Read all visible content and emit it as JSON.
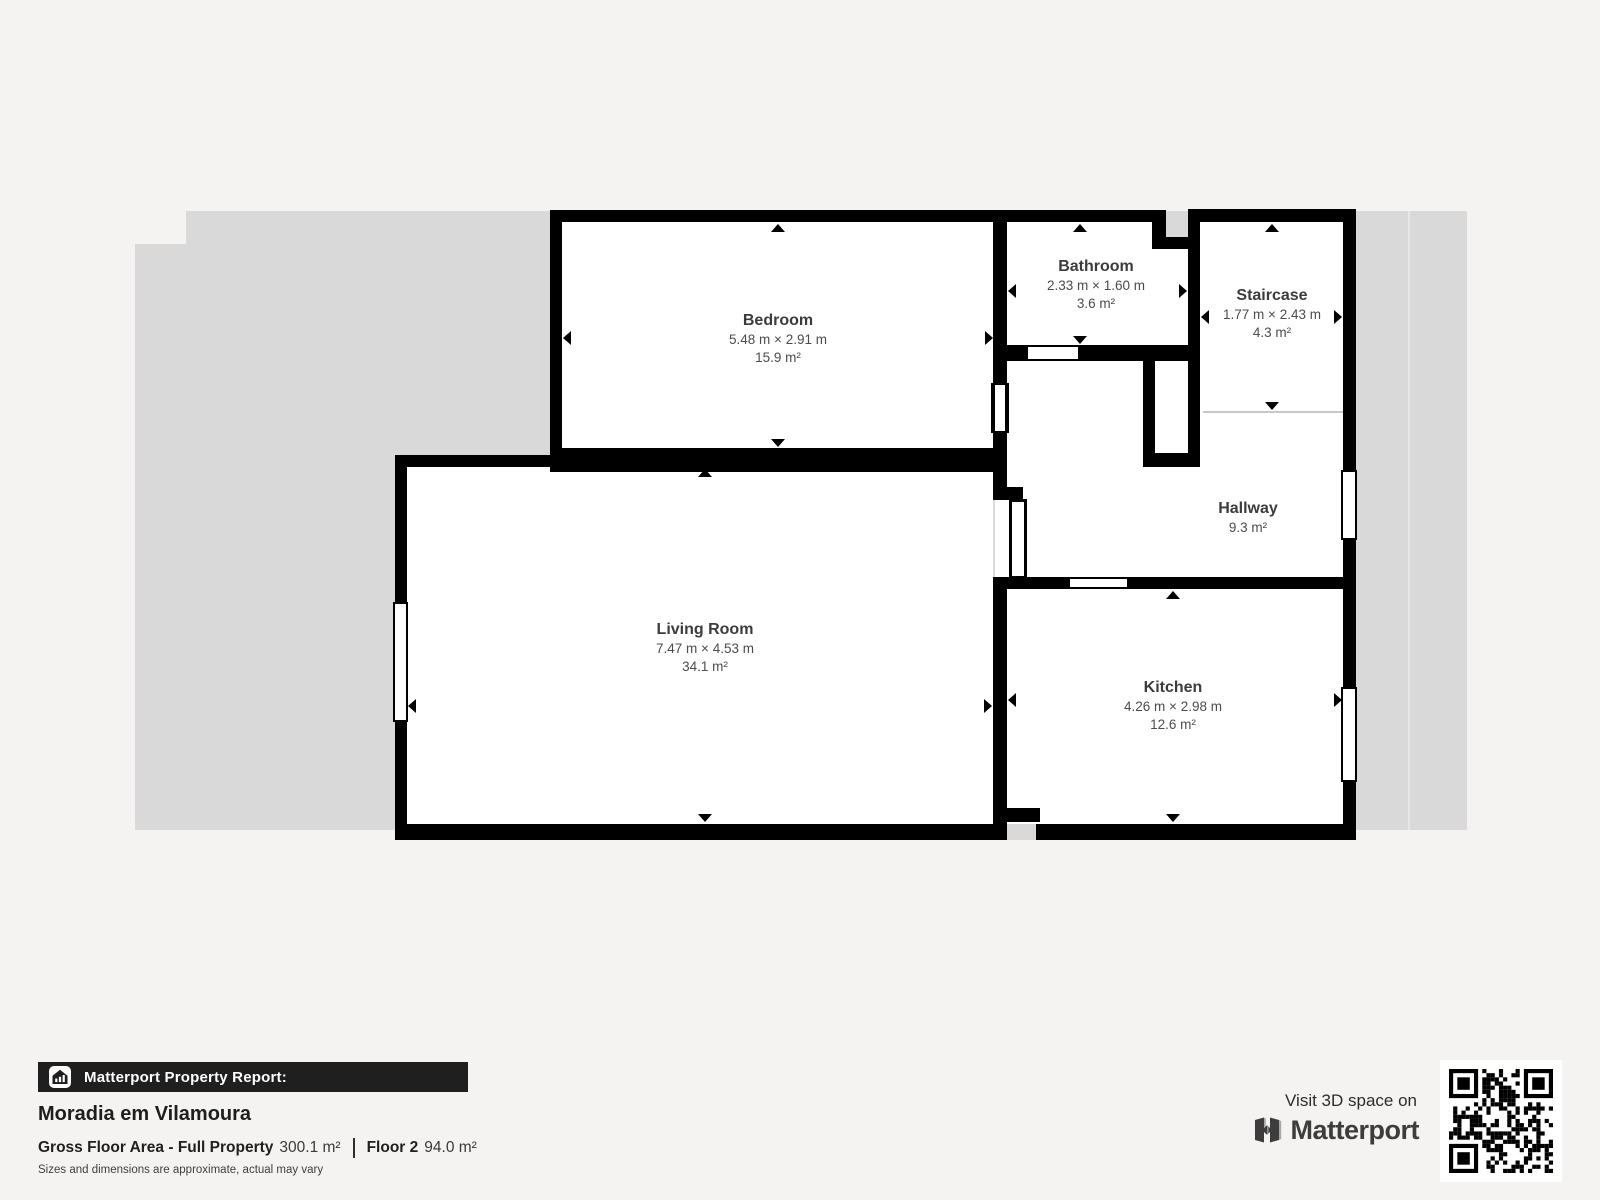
{
  "plan": {
    "rooms": {
      "bedroom": {
        "name": "Bedroom",
        "dimensions": "5.48 m × 2.91 m",
        "area": "15.9 m²"
      },
      "bathroom": {
        "name": "Bathroom",
        "dimensions": "2.33 m × 1.60 m",
        "area": "3.6 m²"
      },
      "staircase": {
        "name": "Staircase",
        "dimensions": "1.77 m × 2.43 m",
        "area": "4.3 m²"
      },
      "hallway": {
        "name": "Hallway",
        "area": "9.3 m²"
      },
      "living_room": {
        "name": "Living Room",
        "dimensions": "7.47 m × 4.53 m",
        "area": "34.1 m²"
      },
      "kitchen": {
        "name": "Kitchen",
        "dimensions": "4.26 m × 2.98 m",
        "area": "12.6 m²"
      }
    },
    "colors": {
      "wall": "#000000",
      "floor": "#ffffff",
      "backdrop": "#d9d9d9",
      "page_background": "#f4f3f1",
      "footer_bar": "#1f1f1f"
    }
  },
  "footer": {
    "report_bar_label": "Matterport Property Report:",
    "property_name": "Moradia em Vilamoura",
    "gross_floor_label": "Gross Floor Area - Full Property",
    "gross_floor_value": "300.1 m²",
    "floor_label": "Floor 2",
    "floor_value": "94.0 m²",
    "disclaimer": "Sizes and dimensions are approximate, actual may vary"
  },
  "cta": {
    "visit_label": "Visit 3D space on",
    "brand_name": "Matterport"
  },
  "icons": [
    "property-report-house-icon",
    "matterport-logo-icon",
    "qr-code",
    "dimension-arrows"
  ]
}
